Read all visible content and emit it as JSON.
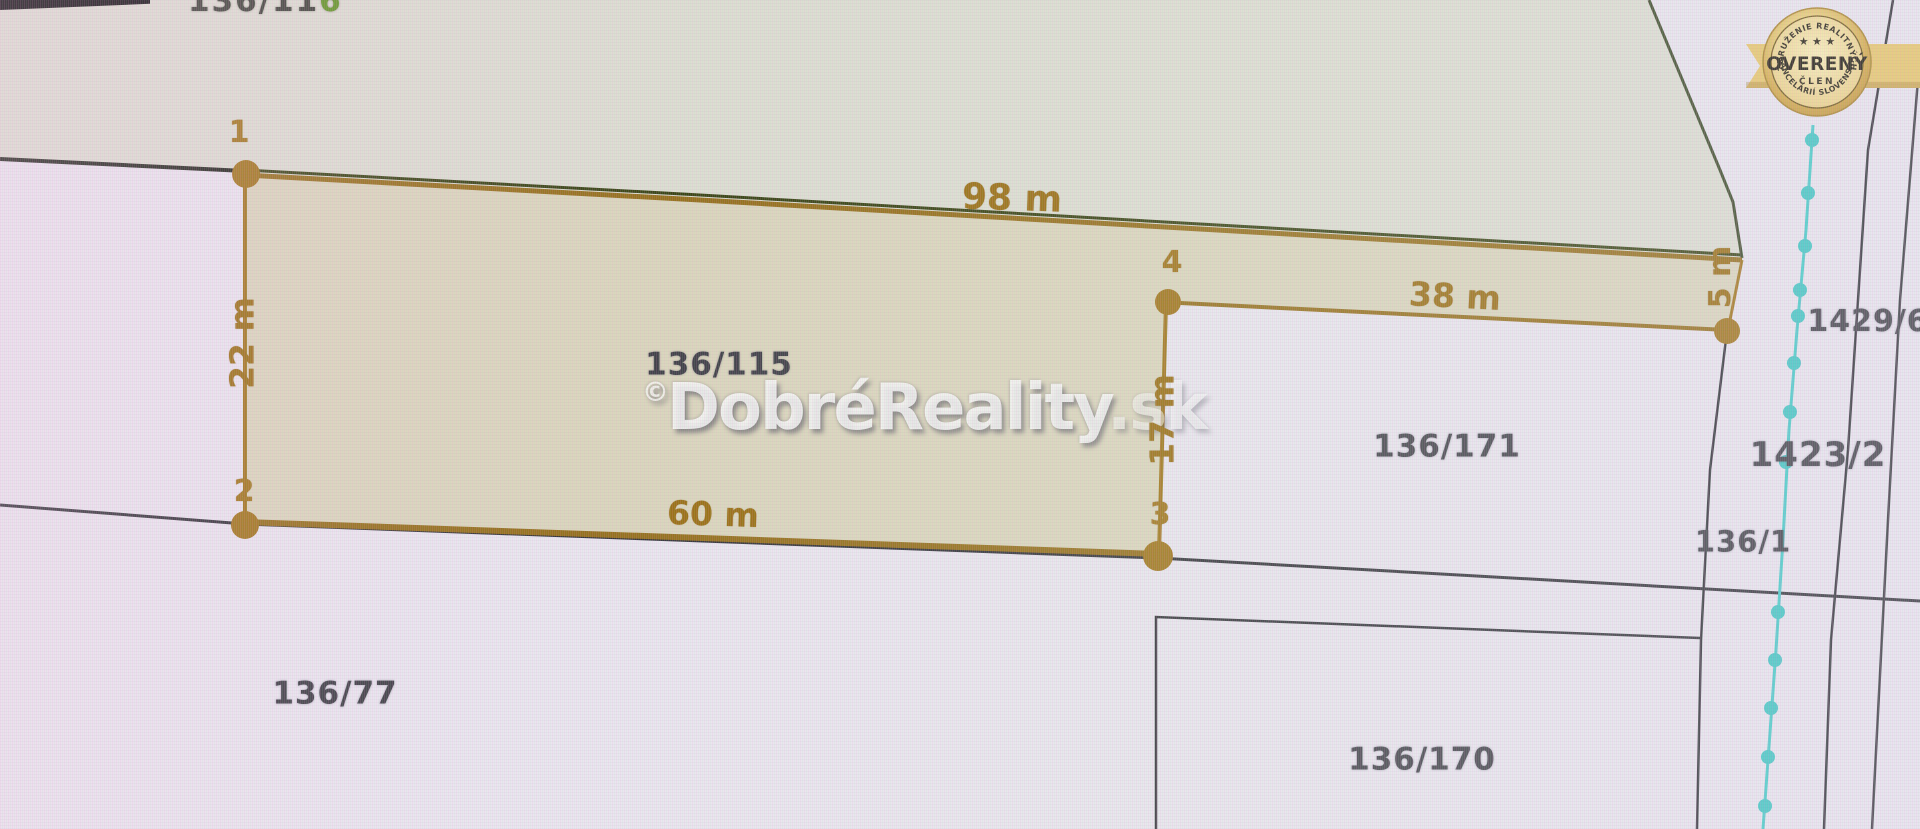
{
  "parcels": {
    "highlighted": "136/115",
    "right": "136/171",
    "bottom_left": "136/77",
    "bottom_right": "136/170",
    "far_right_top": "1429/6",
    "far_right_middle": "1423/2",
    "near_stream": "136/1",
    "top_cut_prefix": "136/11",
    "top_cut_suffix": "6"
  },
  "measurements": {
    "top": "98 m",
    "left": "22 m",
    "bottom": "60 m",
    "inner_vertical": "17 m",
    "upper_right": "38 m",
    "right_edge": "5 m"
  },
  "points": {
    "p1": "1",
    "p2": "2",
    "p3": "3",
    "p4": "4"
  },
  "watermark": {
    "copyright": "©",
    "name": "DobréReality",
    "tld": ".sk"
  },
  "badge": {
    "arc_top": "ZDRUŽENIE REALITNÝCH",
    "stars": "★ ★ ★",
    "title": "OVERENÝ",
    "subtitle": "ČLEN",
    "arc_bottom": "KANCELÁRIÍ SLOVENSKA"
  },
  "colors": {
    "measure_gold": "#9a6f15",
    "dot_gold": "#a1761d",
    "highlight_fill": "#c5be73",
    "stream_cyan": "#45cbc9",
    "boundary_dark": "#33333a",
    "badge_gold": "#e8c76a"
  }
}
